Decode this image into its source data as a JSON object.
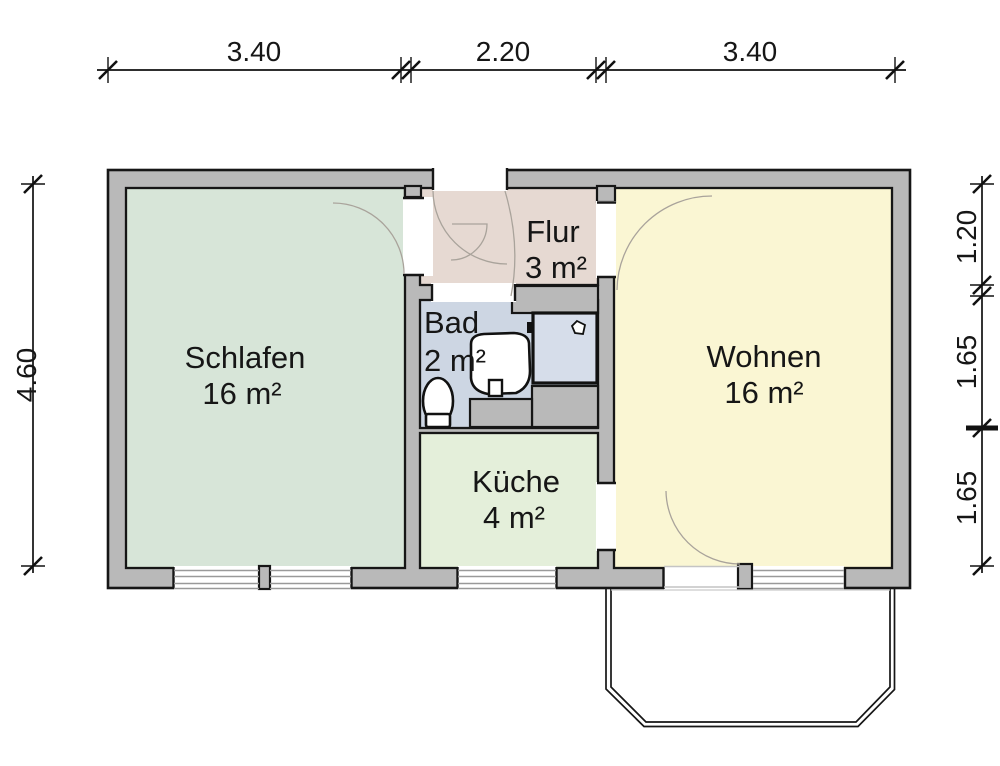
{
  "plan": {
    "rooms": [
      {
        "id": "schlafen",
        "name": "Schlafen",
        "area": "16 m²",
        "color": "#d7e5d8"
      },
      {
        "id": "flur",
        "name": "Flur",
        "area": "3 m²",
        "color": "#e6d9d2"
      },
      {
        "id": "bad",
        "name": "Bad",
        "area": "2 m²",
        "color": "#cdd6e3"
      },
      {
        "id": "kueche",
        "name": "Küche",
        "area": "4 m²",
        "color": "#e4efda"
      },
      {
        "id": "wohnen",
        "name": "Wohnen",
        "area": "16 m²",
        "color": "#faf6d3"
      }
    ],
    "dimensions_top": [
      "3.40",
      "2.20",
      "3.40"
    ],
    "dimension_left": "4.60",
    "dimensions_right": [
      "1.20",
      "1.65",
      "1.65"
    ],
    "colors": {
      "wall": "#b9b9b9",
      "outline": "#161616",
      "fixture_fill": "#ffffff",
      "shower_fill": "#d6ddea",
      "door_arc": "#a9a39b"
    }
  }
}
